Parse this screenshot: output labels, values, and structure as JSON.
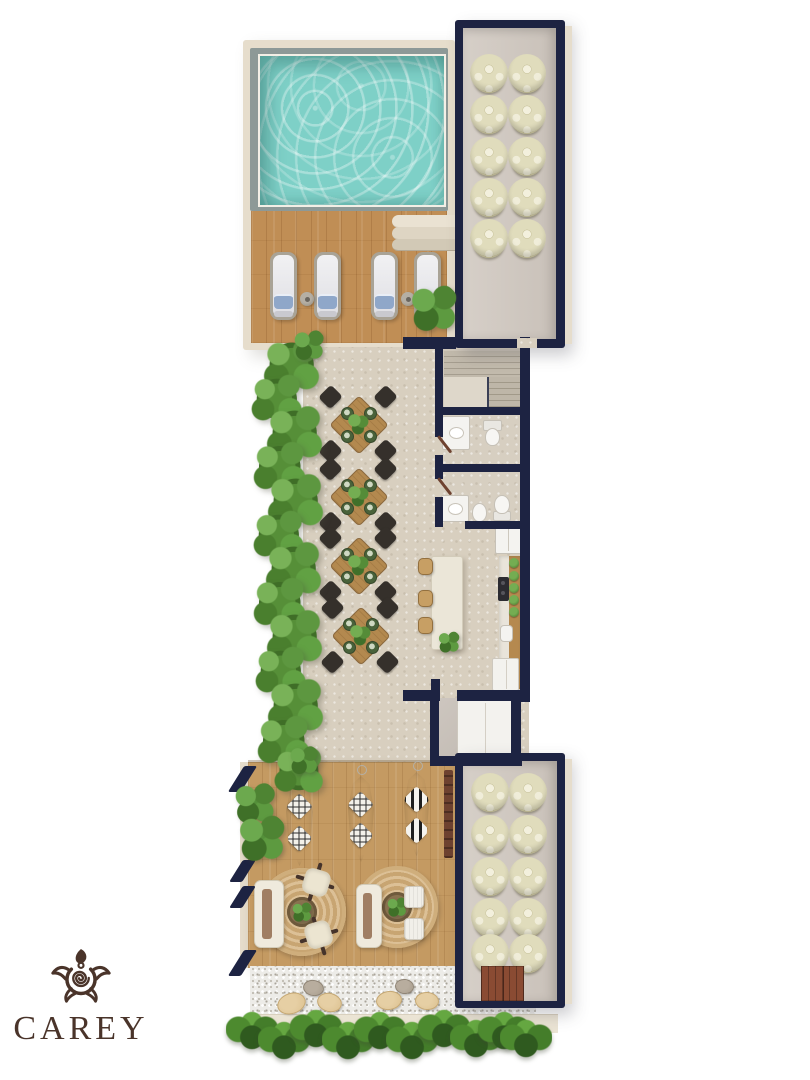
{
  "brand": {
    "name": "CAREY",
    "icon": "turtle-icon",
    "color": "#4a342a"
  },
  "palette": {
    "background": "#ffffff",
    "wall_navy": "#1d2342",
    "wall_beige": "#e6ddcc",
    "pool_water": "#7ed0c7",
    "pool_rim": "#8d9997",
    "deck_wood": "#c08e55",
    "lounge_wood": "#c49a62",
    "stone_floor": "#d8cfbf",
    "stack_cream": "#e0dcbc",
    "rug_jute": "#d0b080",
    "gravel": "#edece8",
    "stone_beige": "#dcc190",
    "stone_gray": "#a79c8c",
    "fixture_white": "#f4f3f0",
    "door_brown": "#6e4230",
    "pillow_blue": "#8fa7c9",
    "chair_dark": "#35302b",
    "table_wood": "#b3894f",
    "island_cream": "#ebe6d8",
    "counter_wood": "#b5894f",
    "mat_red": "#8a4b33",
    "logo_brown": "#4a342a"
  },
  "areas": {
    "pool_terrace": {
      "features": [
        "pool",
        "sun-deck",
        "deck-steps"
      ],
      "lounger_count": 4,
      "side_table_count": 2
    },
    "storage_rooms": {
      "count": 2,
      "stacks_per_room": 10
    },
    "stair_hall": {
      "flights": 2
    },
    "bathrooms": {
      "count": 2
    },
    "kitchen": {
      "island_stool_count": 3,
      "counter_plant_count": 5
    },
    "dining_terrace": {
      "table_count": 4,
      "chairs_per_table": 4,
      "palm_count": 13
    },
    "lounge": {
      "hanging_chair_count": 3,
      "rug_count": 2,
      "sofa_count": 2,
      "butterfly_chair_count": 2,
      "side_chair_count": 2
    },
    "garden": {
      "gravel_stone_count": 6,
      "hedge_tuft_count": 10
    }
  },
  "generated": {
    "loungers": {
      "lefts": [
        270,
        314,
        371,
        414
      ],
      "top": 252,
      "width": 27,
      "height": 68
    },
    "side_tables": [
      {
        "x": 307,
        "y": 299
      },
      {
        "x": 408,
        "y": 299
      }
    ],
    "stack_rooms": [
      {
        "container": "stack-room-top",
        "r": 19,
        "cx": [
          26,
          64
        ],
        "cy": [
          45,
          86,
          128,
          169,
          210
        ]
      },
      {
        "container": "stack-room-bottom",
        "r": 19,
        "cx": [
          27,
          65
        ],
        "cy": [
          31,
          73,
          115,
          156,
          192
        ]
      }
    ],
    "palms": [
      {
        "x": 293,
        "y": 366,
        "s": 66
      },
      {
        "x": 278,
        "y": 400,
        "s": 60
      },
      {
        "x": 296,
        "y": 434,
        "s": 66
      },
      {
        "x": 281,
        "y": 468,
        "s": 62
      },
      {
        "x": 297,
        "y": 502,
        "s": 66
      },
      {
        "x": 280,
        "y": 536,
        "s": 60
      },
      {
        "x": 295,
        "y": 570,
        "s": 66
      },
      {
        "x": 281,
        "y": 604,
        "s": 62
      },
      {
        "x": 296,
        "y": 638,
        "s": 66
      },
      {
        "x": 282,
        "y": 672,
        "s": 60
      },
      {
        "x": 297,
        "y": 707,
        "s": 66
      },
      {
        "x": 285,
        "y": 742,
        "s": 62
      },
      {
        "x": 300,
        "y": 772,
        "s": 58
      }
    ],
    "dining_sets": [
      {
        "x": 358,
        "y": 424
      },
      {
        "x": 358,
        "y": 496
      },
      {
        "x": 358,
        "y": 565
      },
      {
        "x": 360,
        "y": 635
      }
    ],
    "island_stools": {
      "x": 418,
      "ys": [
        565,
        597,
        624
      ],
      "w": 13,
      "h": 15
    },
    "counter_plants": {
      "x": 514,
      "ys": [
        563,
        576,
        588,
        600,
        612
      ],
      "r": 5
    },
    "hanging_chairs": [
      {
        "x": 286,
        "y": 778,
        "w": 27,
        "h": 88,
        "pattern": "diamond"
      },
      {
        "x": 348,
        "y": 776,
        "w": 26,
        "h": 86,
        "pattern": "diamond"
      },
      {
        "x": 404,
        "y": 772,
        "w": 25,
        "h": 84,
        "pattern": "chevron"
      }
    ],
    "gravel_stones": [
      {
        "x": 290,
        "y": 1002,
        "w": 27,
        "h": 19,
        "rot": -18,
        "tone": "beige"
      },
      {
        "x": 312,
        "y": 987,
        "w": 19,
        "h": 14,
        "rot": 10,
        "tone": "gray"
      },
      {
        "x": 328,
        "y": 1001,
        "w": 23,
        "h": 17,
        "rot": 14,
        "tone": "beige"
      },
      {
        "x": 388,
        "y": 999,
        "w": 24,
        "h": 17,
        "rot": -8,
        "tone": "beige"
      },
      {
        "x": 403,
        "y": 985,
        "w": 17,
        "h": 13,
        "rot": 6,
        "tone": "gray"
      },
      {
        "x": 426,
        "y": 1000,
        "w": 22,
        "h": 16,
        "rot": 4,
        "tone": "beige"
      }
    ],
    "hedge_tufts": [
      {
        "x": 252,
        "y": 1030
      },
      {
        "x": 284,
        "y": 1040
      },
      {
        "x": 316,
        "y": 1028
      },
      {
        "x": 348,
        "y": 1040
      },
      {
        "x": 380,
        "y": 1030
      },
      {
        "x": 412,
        "y": 1040
      },
      {
        "x": 444,
        "y": 1028
      },
      {
        "x": 476,
        "y": 1038
      },
      {
        "x": 504,
        "y": 1030
      },
      {
        "x": 526,
        "y": 1038
      }
    ]
  }
}
